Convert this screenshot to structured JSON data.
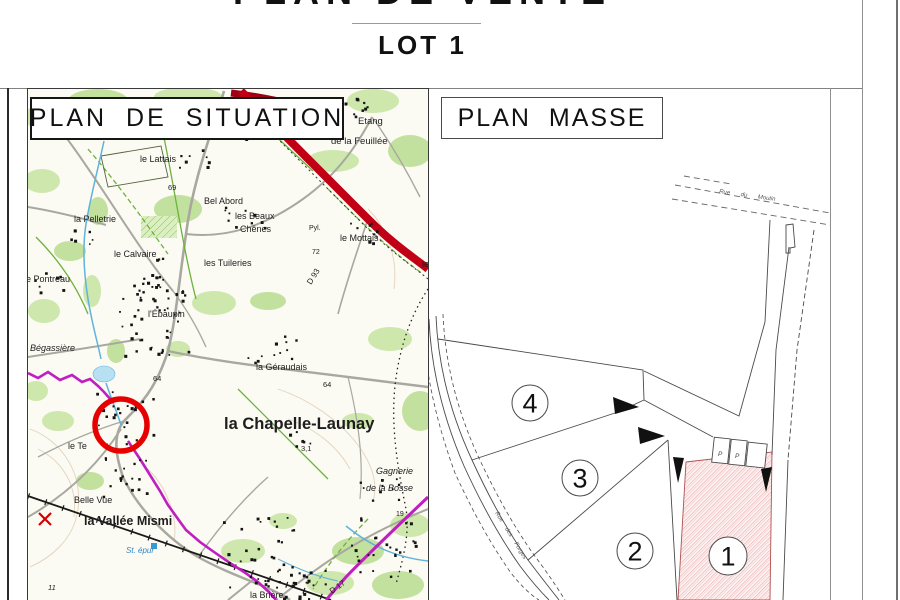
{
  "header": {
    "title": "PLAN DE VENTE",
    "subtitle": "LOT 1"
  },
  "situation_panel": {
    "title": "PLAN DE SITUATION",
    "map_labels": [
      {
        "text": "le Lattais",
        "x": 112,
        "y": 73
      },
      {
        "text": "le Tillon",
        "x": 206,
        "y": 43
      },
      {
        "text": "Etang",
        "x": 330,
        "y": 35,
        "size": 9.5
      },
      {
        "text": "de la Feuillée",
        "x": 303,
        "y": 55,
        "size": 9.5
      },
      {
        "text": "69",
        "x": 140,
        "y": 101,
        "size": 7.5
      },
      {
        "text": "Bel Abord",
        "x": 176,
        "y": 115
      },
      {
        "text": "la Pelletrie",
        "x": 46,
        "y": 133
      },
      {
        "text": "les Beaux",
        "x": 207,
        "y": 130
      },
      {
        "text": "Chênes",
        "x": 212,
        "y": 143
      },
      {
        "text": "Pyl.",
        "x": 281,
        "y": 141,
        "size": 7
      },
      {
        "text": "le Mottais",
        "x": 312,
        "y": 152
      },
      {
        "text": "72",
        "x": 284,
        "y": 165,
        "size": 7
      },
      {
        "text": "D 93",
        "x": 283,
        "y": 196,
        "size": 8,
        "rot": -58
      },
      {
        "text": "le Calvaire",
        "x": 86,
        "y": 168
      },
      {
        "text": "les Tuileries",
        "x": 176,
        "y": 177
      },
      {
        "text": "le Pontreau",
        "x": -4,
        "y": 193
      },
      {
        "text": "le",
        "x": 394,
        "y": 178
      },
      {
        "text": "l'Ébaupin",
        "x": 120,
        "y": 228
      },
      {
        "text": "Bégassière",
        "x": 2,
        "y": 262,
        "italic": true
      },
      {
        "text": "la Géraudais",
        "x": 228,
        "y": 281
      },
      {
        "text": "64",
        "x": 125,
        "y": 292,
        "size": 7.5
      },
      {
        "text": "64",
        "x": 295,
        "y": 298,
        "size": 7.5
      },
      {
        "text": "la Chapelle-Launay",
        "x": 196,
        "y": 340,
        "size": 16.5,
        "bold": true
      },
      {
        "text": "3,1",
        "x": 273,
        "y": 362,
        "size": 7.5
      },
      {
        "text": "le Te",
        "x": 40,
        "y": 360
      },
      {
        "text": "Belle Vue",
        "x": 46,
        "y": 414
      },
      {
        "text": "la Vallée Mismi",
        "x": 56,
        "y": 436,
        "size": 12.5,
        "bold": true
      },
      {
        "text": "St. épur",
        "x": 98,
        "y": 464,
        "size": 8,
        "italic": true,
        "color": "#2f86c8"
      },
      {
        "text": "la Brière",
        "x": 222,
        "y": 509
      },
      {
        "text": "Gagnerie",
        "x": 348,
        "y": 385,
        "italic": true
      },
      {
        "text": "de la Bosse",
        "x": 338,
        "y": 402,
        "italic": true
      },
      {
        "text": "19",
        "x": 368,
        "y": 427,
        "size": 7
      },
      {
        "text": "11",
        "x": 20,
        "y": 501,
        "size": 7.5,
        "italic": true
      },
      {
        "text": "D 17",
        "x": 304,
        "y": 505,
        "size": 8,
        "rot": -36
      }
    ]
  },
  "masse_panel": {
    "title": "PLAN MASSE",
    "street_labels": [
      {
        "text": "Rue du Moulin",
        "x": 290,
        "y": 104,
        "rot": 8,
        "size": 6,
        "ws": 9
      },
      {
        "text": "Rue des Forges",
        "x": 66,
        "y": 424,
        "rot": 58,
        "size": 6,
        "ws": 6
      }
    ],
    "lots": [
      {
        "number": "4",
        "cx": 101,
        "cy": 314,
        "r": 18,
        "highlighted": false
      },
      {
        "number": "3",
        "cx": 151,
        "cy": 389,
        "r": 18,
        "highlighted": false
      },
      {
        "number": "2",
        "cx": 206,
        "cy": 462,
        "r": 18,
        "highlighted": false
      },
      {
        "number": "1",
        "cx": 299,
        "cy": 467,
        "r": 19,
        "highlighted": true
      }
    ],
    "parking_labels": [
      {
        "text": "P",
        "x": 289,
        "y": 367
      },
      {
        "text": "P",
        "x": 306,
        "y": 369
      }
    ]
  },
  "colors": {
    "lot_highlight_fill": "#fdf1f1",
    "lot_highlight_hatch": "#e5a8a8",
    "lot_highlight_border": "#b05050",
    "location_circle": "#e60000",
    "highway_red": "#c10016",
    "trail_magenta": "#c01ec0",
    "stream_blue": "#5fb3dc",
    "vegetation_green": "#cde7ad"
  }
}
